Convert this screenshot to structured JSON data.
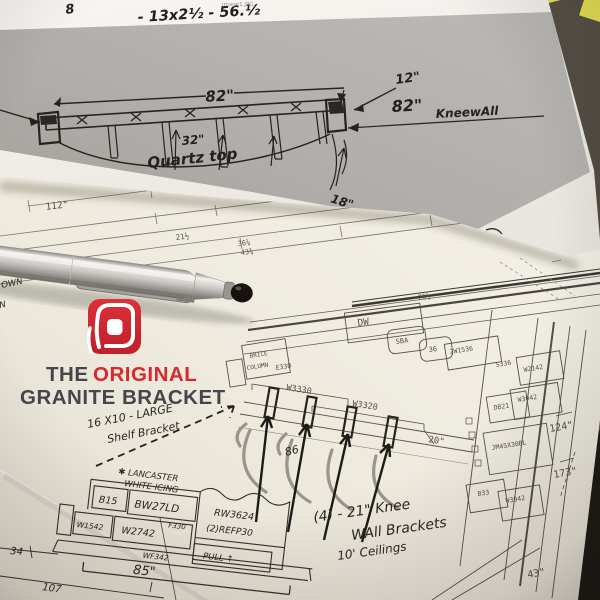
{
  "logo": {
    "line1_the": "THE",
    "line1_original": "ORIGINAL",
    "line2": "GRANITE BRACKET",
    "red": "#d7282f",
    "dark": "#46454a"
  },
  "sticky_note_color": "#e7e052",
  "top_sketch": {
    "filename": "image1.JPG",
    "page_note": "8",
    "size_note": "- 13x2½ - 56.½",
    "overall_width": "82\"",
    "offset": "12\"",
    "kneewall_length": "82\"",
    "kneewall_word": "KneewAll",
    "depth": "32\"",
    "material": "Quartz top",
    "corner": "18\""
  },
  "plan": {
    "dims": {
      "overall": "112\"",
      "d21": "21½",
      "d36": "36¼",
      "d43": "43¾",
      "d76": "76½",
      "right_upper": "124\"",
      "right_lower": "173\"",
      "bottom_right": "43\"",
      "knee_depth": "20\"",
      "island_width": "85\"",
      "left": "34",
      "bottom_left": "107",
      "pencil": "86"
    },
    "cabinets": {
      "dw": "DW",
      "sink1": "SBA",
      "sink2": "36",
      "c1": "2W1536",
      "c2": "S336",
      "c3": "W2142",
      "c4": "W3042",
      "c5": "DB21",
      "c6": "JM45X30BL",
      "c7": "B33",
      "c8": "W3042",
      "brice1": "BRICE",
      "brice2": "COLUMN",
      "e330": "E330",
      "w3330": "W3330",
      "w3320": "W3320"
    },
    "island": {
      "c1": "B15",
      "c2": "BW27LD",
      "c3": "F330",
      "c4": "W1542",
      "c5": "W2742",
      "c6": "WF342",
      "c7": "RW3624",
      "c8": "(2)REFP30",
      "c9": "PULL ↑"
    },
    "notes": {
      "shelf1": "16 X10 - LARGE",
      "shelf2": "Shelf Bracket",
      "knee1": "(4) - 21\" Knee",
      "knee2": "WAll Brackets",
      "ceilings": "10' Ceilings",
      "finish1": "✱ LANCASTER",
      "finish2": "WHITE ICING",
      "cut1": "ICE",
      "cut2": "OWN",
      "cut3": "N"
    }
  }
}
